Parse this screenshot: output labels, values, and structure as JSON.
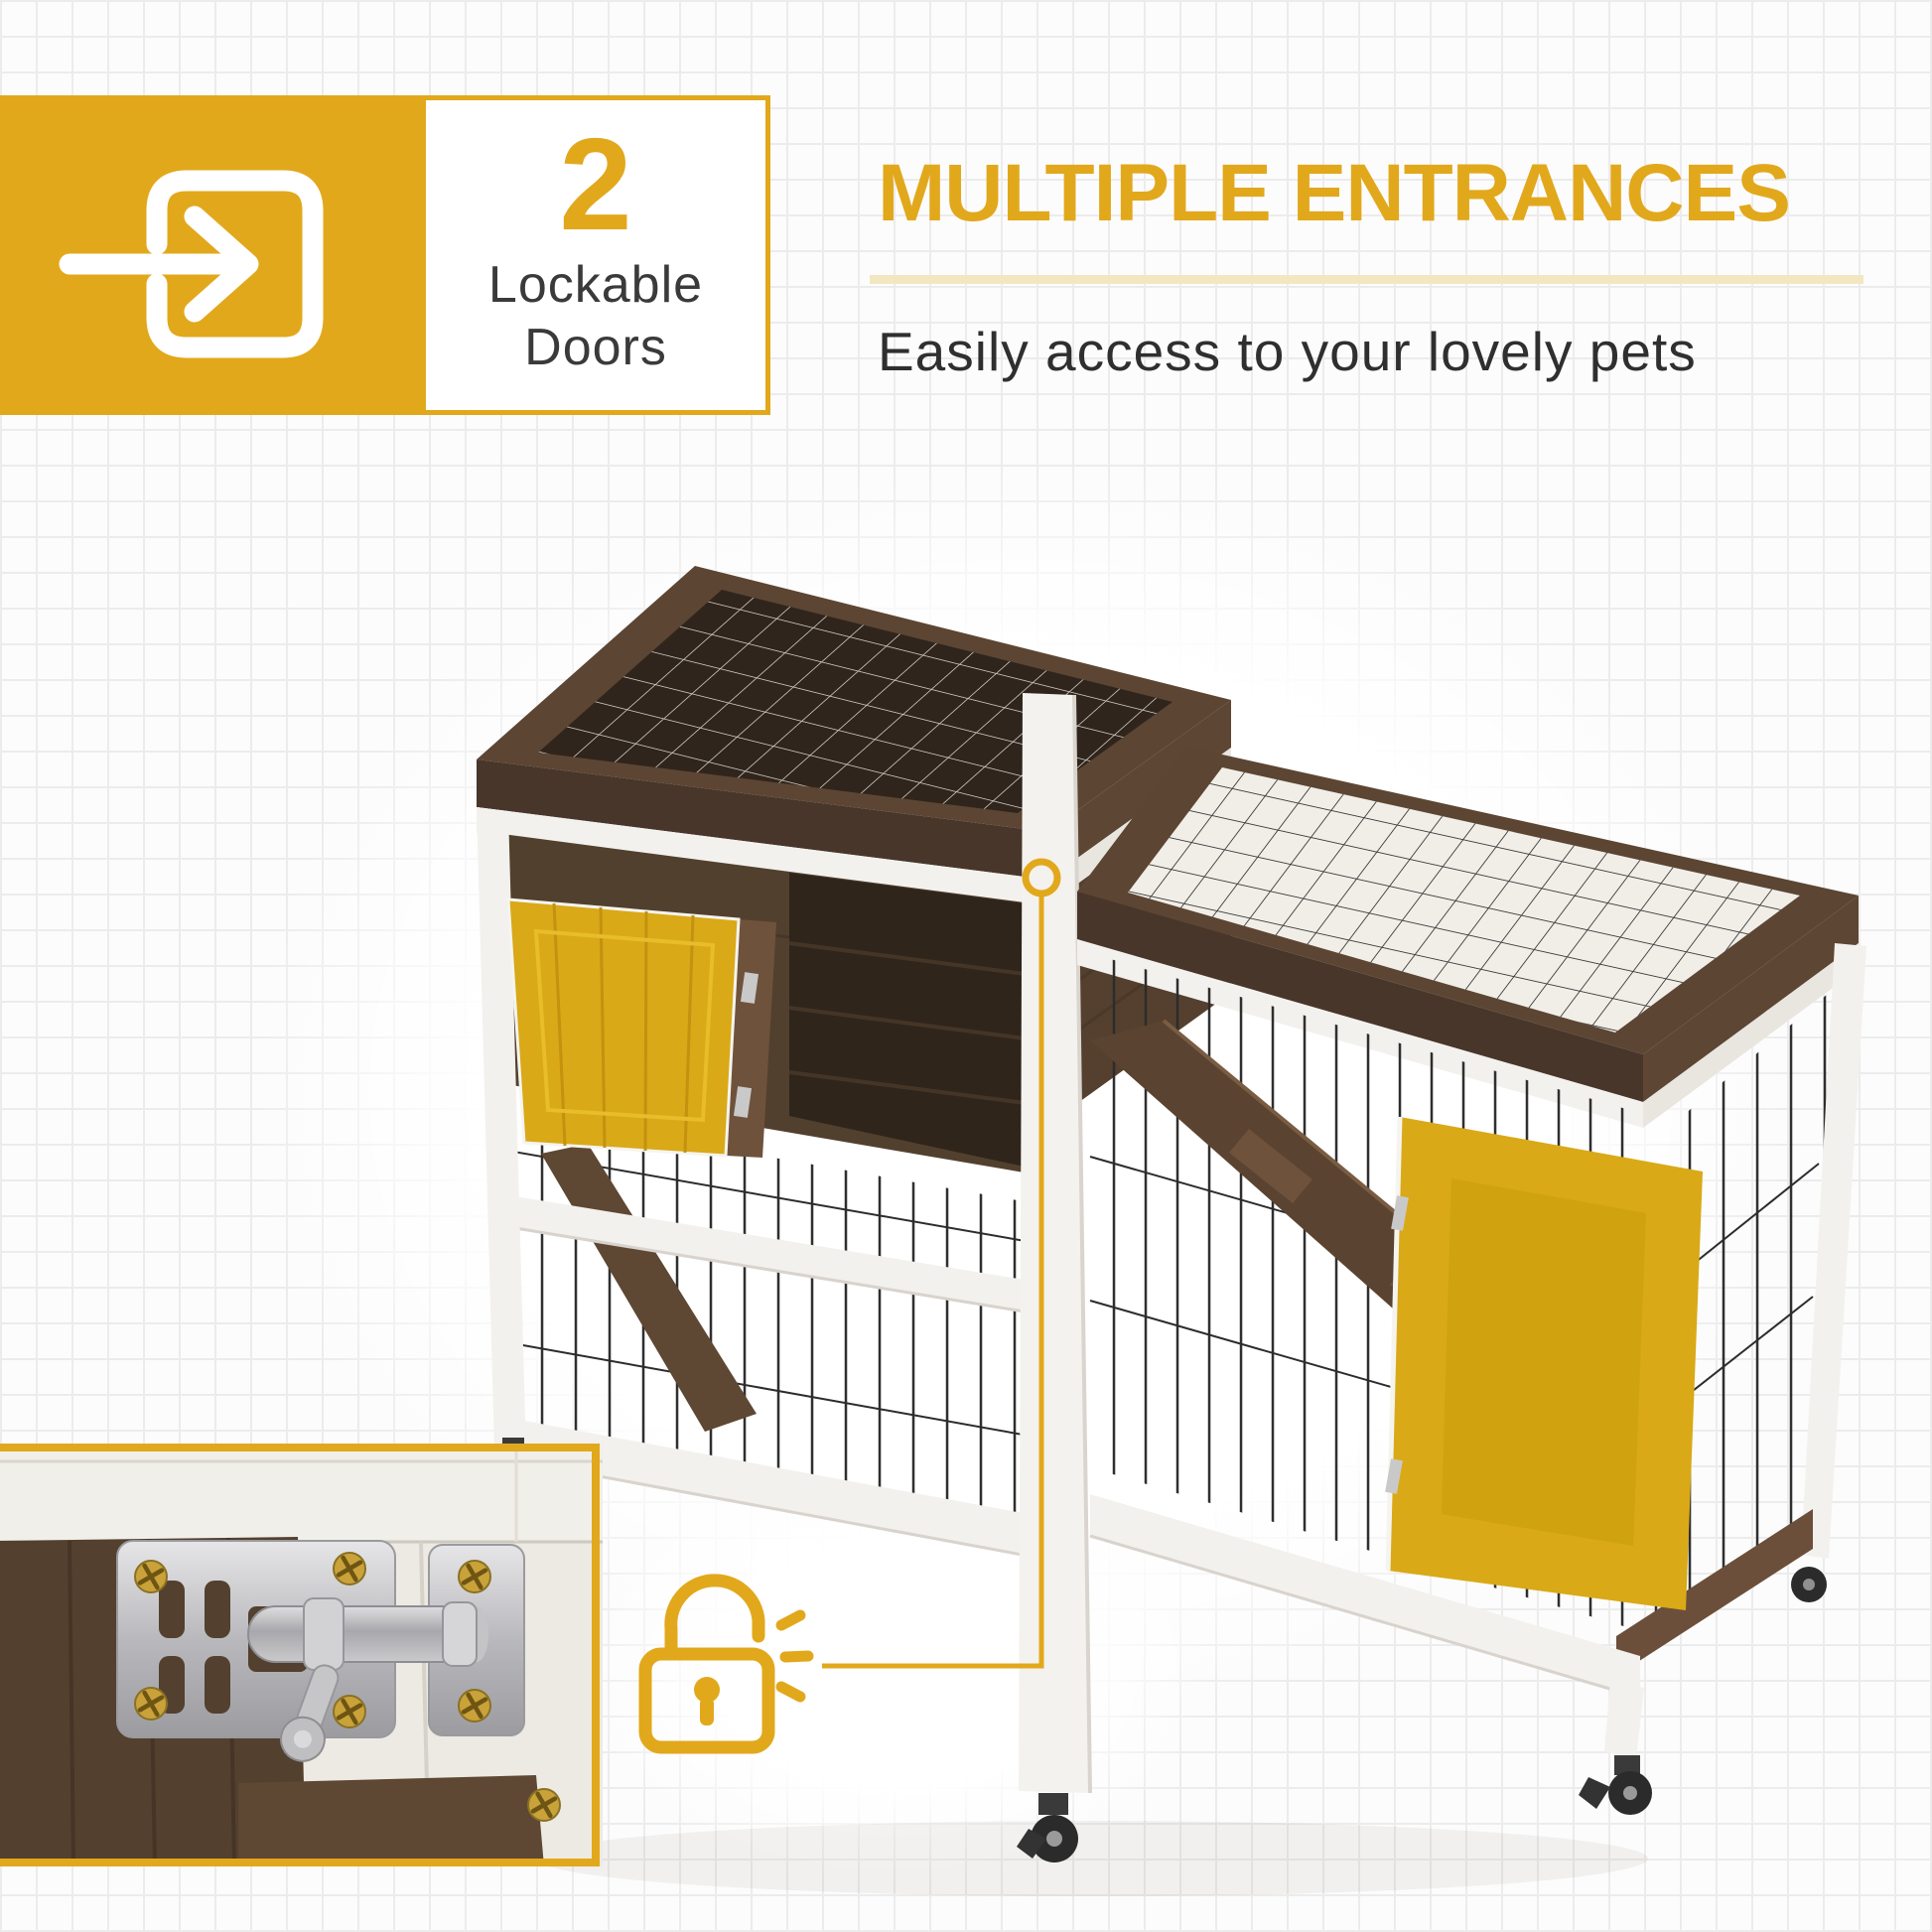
{
  "theme": {
    "accent_gold": "#E2A81C",
    "door_highlight": "#D9A917",
    "pale_underline": "#F3E7C2",
    "text_dark": "#2F2F2F",
    "wood_brown": "#52402F",
    "wood_white": "#F3F1ED",
    "background": "#FCFCFC",
    "grid_line": "#ECECEC"
  },
  "badge": {
    "icon": "enter-door-arrow-icon",
    "count": "2",
    "label_line1": "Lockable",
    "label_line2": "Doors"
  },
  "headline": {
    "title": "MULTIPLE ENTRANCES",
    "subtitle": "Easily access to your lovely pets"
  },
  "callout": {
    "icon": "open-padlock-icon",
    "marker": "latch-location-circle"
  },
  "photos": {
    "main_alt": "Two-level wooden rabbit hutch on caster wheels with wire mesh tops, brown wood frame, white posts, two yellow-highlighted lockable doors and an interior ramp",
    "inset_alt": "Close-up of stainless steel sliding barrel bolt latch with gold screws on the hutch door"
  }
}
